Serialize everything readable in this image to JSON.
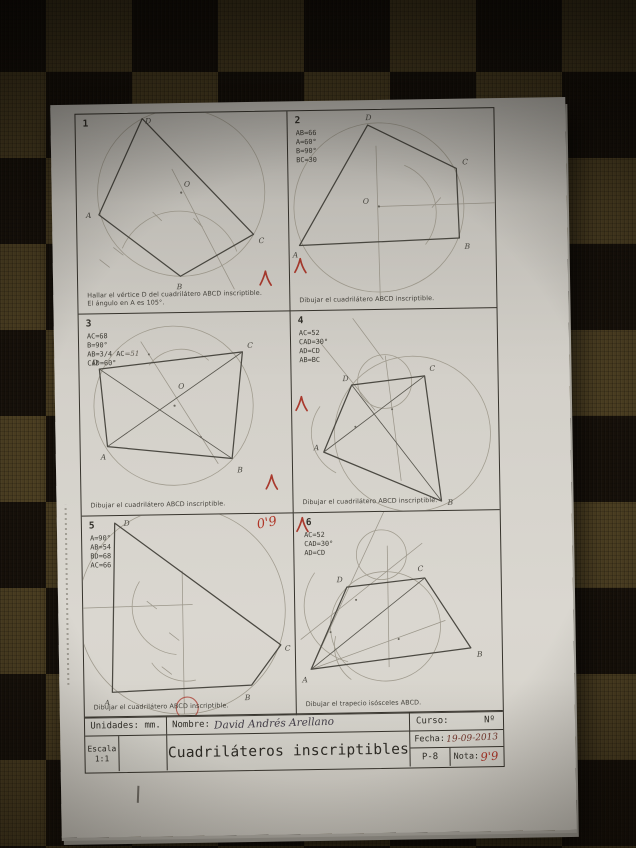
{
  "colors": {
    "paper": "#d6d3cc",
    "ink": "#33312b",
    "pencil": "#4b4942",
    "construction": "#a29d90",
    "red_pen": "#a93a2e",
    "frame": "#37342d",
    "mat_light": "#4c3f22",
    "mat_dark": "#17110a"
  },
  "labels": {
    "A": "A",
    "B": "B",
    "C": "C",
    "D": "D",
    "O": "O"
  },
  "panels": [
    {
      "number": "1",
      "data_lines": [],
      "instruction_lines": [
        "Hallar el vértice D del cuadrilátero ABCD inscriptible.",
        "El ángulo en A es 105°."
      ]
    },
    {
      "number": "2",
      "data_lines": [
        "AB=66",
        "A=60°",
        "B=90°",
        "BC=30"
      ],
      "instruction_lines": [
        "Dibujar el cuadrilátero ABCD inscriptible."
      ]
    },
    {
      "number": "3",
      "data_lines": [
        "AC=68",
        "B=90°",
        "AB=3/4 AC",
        "CAD=60°"
      ],
      "handwritten_note": "=51",
      "instruction_lines": [
        "Dibujar el cuadrilátero ABCD inscriptible."
      ]
    },
    {
      "number": "4",
      "data_lines": [
        "AC=52",
        "CAD=30°",
        "AD=CD",
        "AB=BC"
      ],
      "instruction_lines": [
        "Dibujar el cuadrilátero ABCD inscriptible."
      ]
    },
    {
      "number": "5",
      "data_lines": [
        "A=90°",
        "AB=54",
        "BD=68",
        "AC=66"
      ],
      "grade_mark": "0'9",
      "instruction_lines": [
        "Dibujar el cuadrilátero ABCD inscriptible."
      ]
    },
    {
      "number": "6",
      "data_lines": [
        "AC=52",
        "CAD=30°",
        "AD=CD"
      ],
      "instruction_lines": [
        "Dibujar el trapecio isósceles ABCD."
      ]
    }
  ],
  "titleblock": {
    "unidades": "Unidades: mm.",
    "nombre_label": "Nombre:",
    "nombre_value": "David Andrés Arellano",
    "curso_label": "Curso:",
    "numero_label": "Nº",
    "escala_label": "Escala",
    "escala_value": "1:1",
    "title": "Cuadriláteros inscriptibles",
    "fecha_label": "Fecha:",
    "fecha_value": "19-09-2013",
    "plate": "P-8",
    "nota_label": "Nota:",
    "nota_value": "9'9"
  }
}
